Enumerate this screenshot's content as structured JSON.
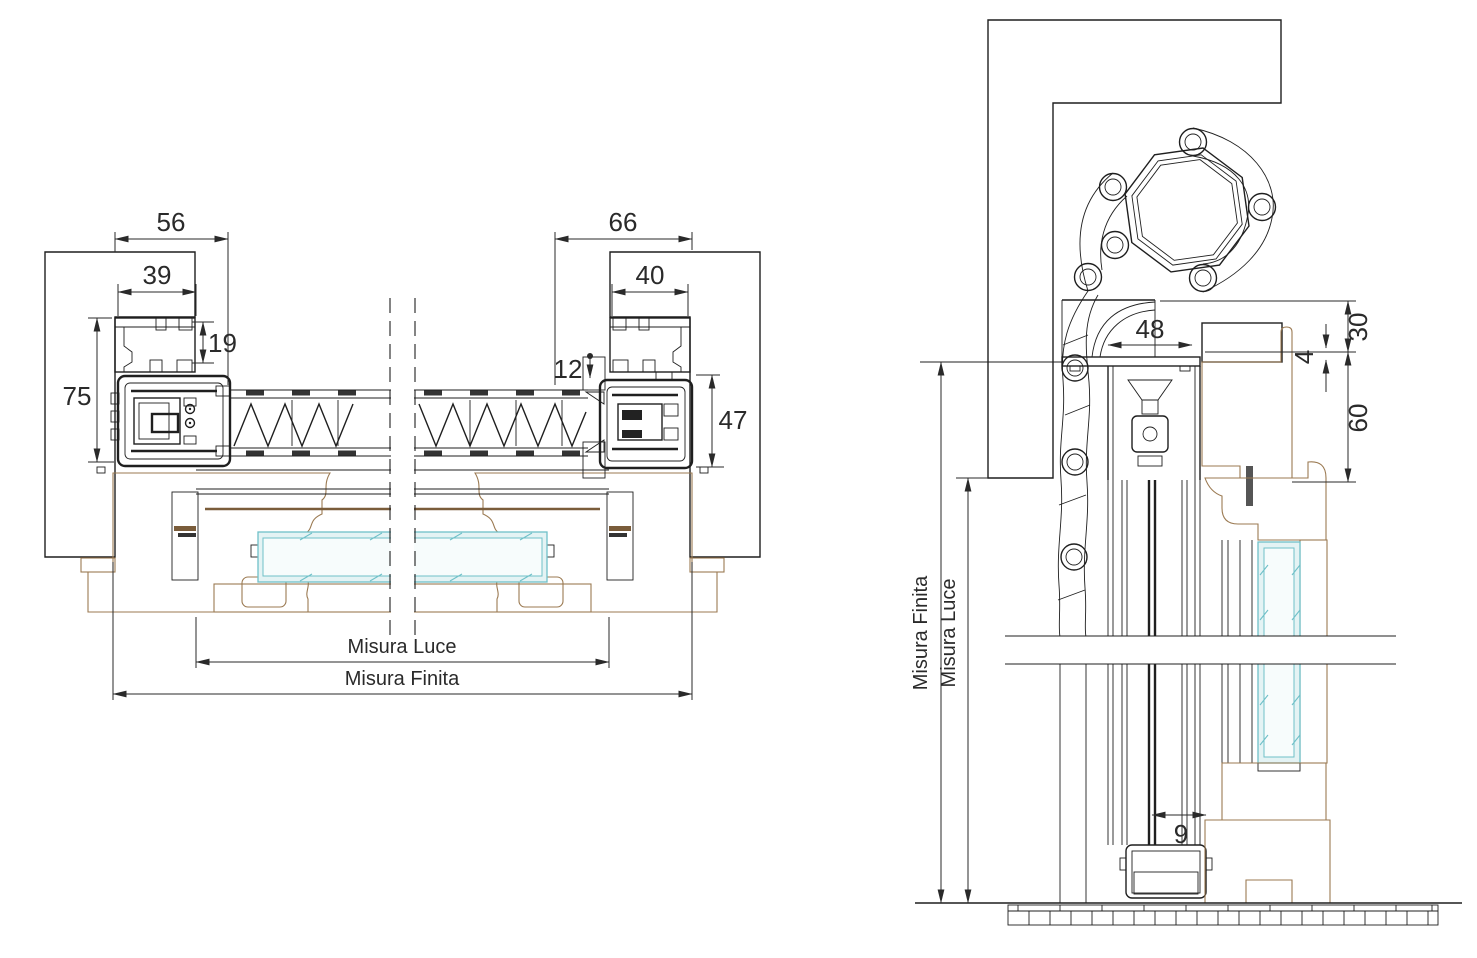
{
  "colors": {
    "line": "#1f1f1f",
    "wood": "#9b7a52",
    "woodDark": "#7a5c3a",
    "glassBorder": "#6fc0c8",
    "glassFill": "#e4f3f4",
    "glassCore": "#f7fcfc",
    "dim": "#2a2a2a",
    "paper": "#ffffff"
  },
  "left_drawing": {
    "title": "horizontal-section-through-jambs",
    "dims": {
      "total_left": "56",
      "profile_left": "39",
      "depth_small_left": "19",
      "depth_total_left": "75",
      "gap_center": "12",
      "total_right": "66",
      "profile_right": "40",
      "depth_total_right": "47",
      "misura_luce": "Misura Luce",
      "misura_finita": "Misura Finita"
    }
  },
  "right_drawing": {
    "title": "vertical-section-with-roller-shutter",
    "dims": {
      "box_width": "48",
      "top_offset": "30",
      "gap_small": "4",
      "lintel_height": "60",
      "bottom_gap": "9",
      "misura_finita": "Misura Finita",
      "misura_luce": "Misura Luce"
    }
  }
}
